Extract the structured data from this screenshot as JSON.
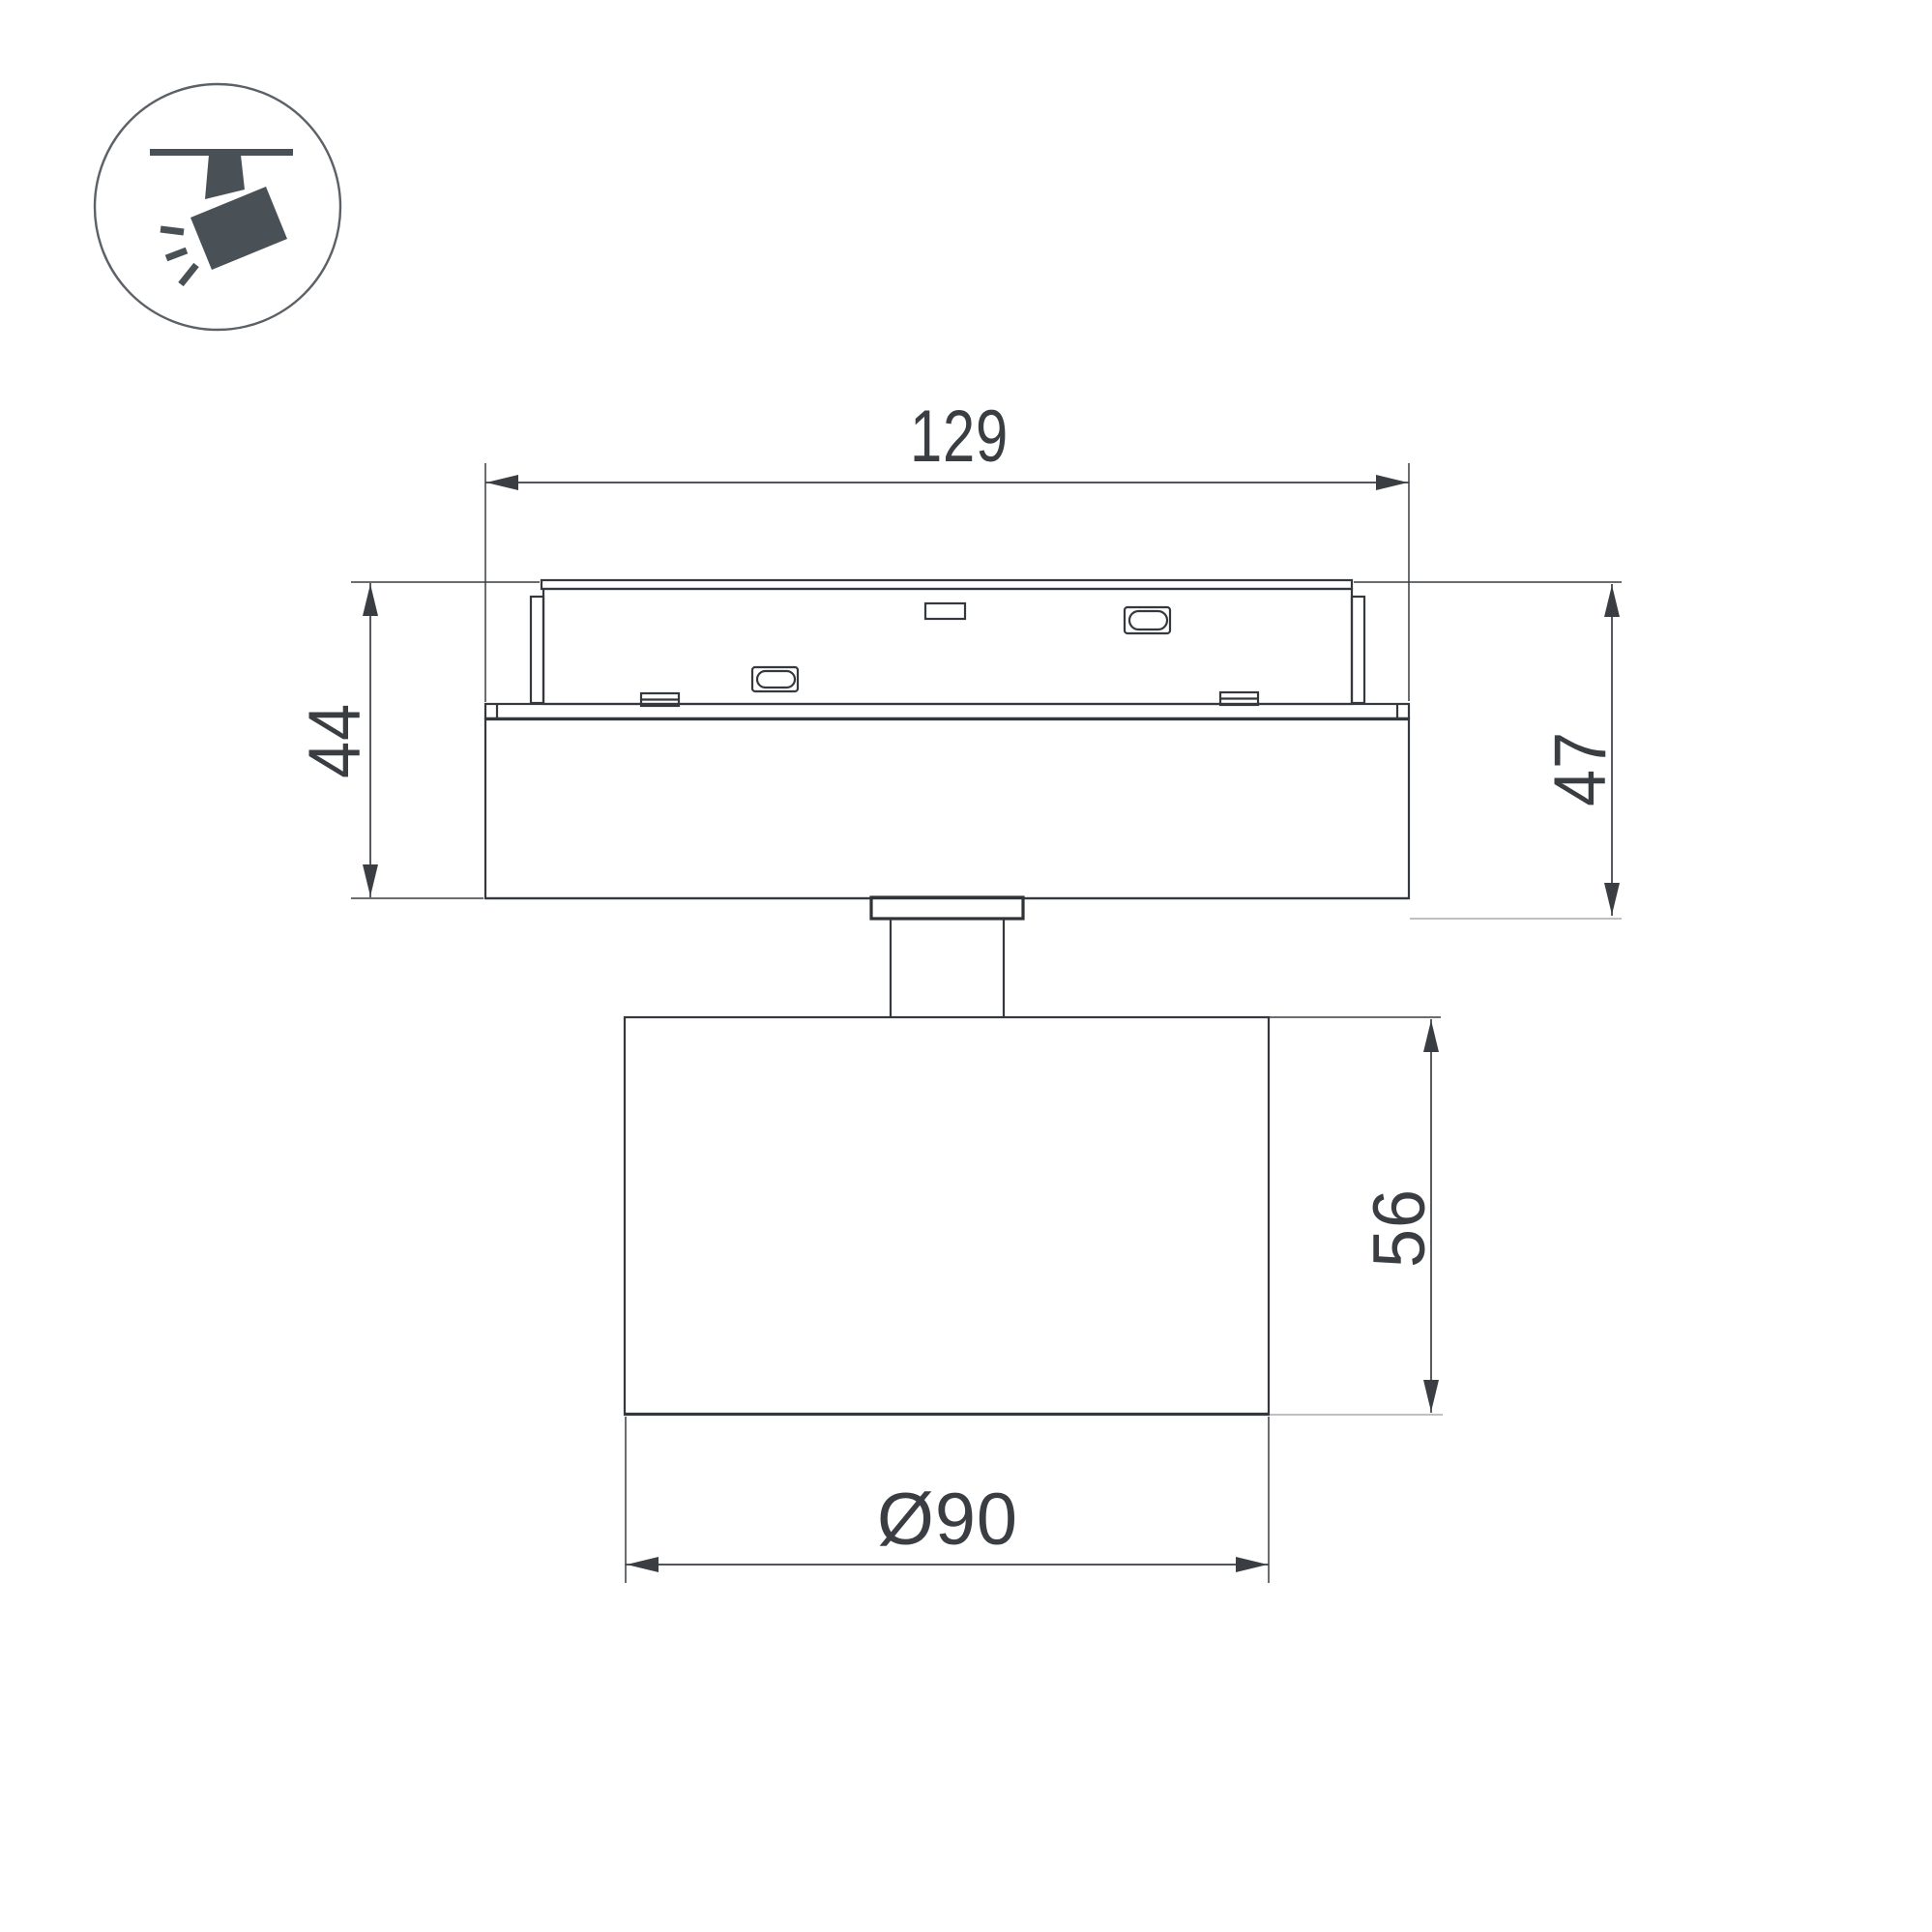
{
  "page": {
    "background_color": "#ffffff",
    "description_labels": {}
  },
  "icon": {
    "name": "ceiling-track-spotlight-icon",
    "glyph_color": "#4a5156",
    "ring_color": "#5b6166"
  },
  "drawing": {
    "line_color": "#35393e",
    "light_line_color": "#aaacad",
    "text_color": "#3a3e42",
    "dimensions": {
      "width_top": "129",
      "height_left": "44",
      "height_right": "47",
      "head_height": "56",
      "head_diameter": "Ø90"
    }
  }
}
